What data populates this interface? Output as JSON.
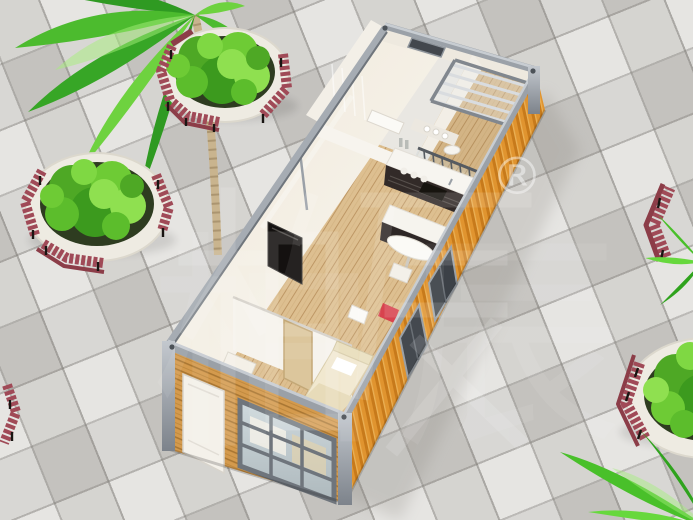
{
  "watermark": {
    "text": "柏辰",
    "registered": "®"
  },
  "palette": {
    "plaza_tile": "#d6d4d0",
    "tile_grout": "#b4b2ae",
    "container_orange": "#ed9c35",
    "container_orange_dark": "#d17f1f",
    "steel_frame": "#9aa0a7",
    "interior_wall": "#f6f2ea",
    "wood_floor": "#ddbf90",
    "facade_slat": "#d49a4d",
    "cabinet_dark": "#322a28",
    "counter_white": "#f7f5f0",
    "bed_linen": "#f1e8cf",
    "bedroom_door_tan": "#dcc69c",
    "bench_red": "#a04a57",
    "bench_back_red": "#8c3d48",
    "planter_white": "#eeebe2",
    "soil_dark": "#2e3c20",
    "plant_green": "#6ecb35",
    "palm_trunk": "#c9b48e",
    "tv_black": "#141110",
    "window_dark": "#3c4147"
  },
  "scene": {
    "setting": "aerial view of a tiled outdoor plaza",
    "building": {
      "type": "flat-pack container house shown with roof removed (dollhouse cutaway)",
      "exterior": [
        "orange corrugated steel side wall",
        "gray steel frame and corner posts",
        "wood-slat front facade with white door and gridded window"
      ],
      "rooms": [
        "bathroom",
        "glazed balcony with pergola slats",
        "kitchen",
        "living area",
        "bedroom",
        "hallway"
      ],
      "furniture": [
        "wall-mounted TV",
        "kitchen cabinets and counters",
        "bar table with stool",
        "bed with headboard shelf",
        "wardrobe",
        "tan bedroom door",
        "red accent chair",
        "balcony chair"
      ]
    },
    "landscaping": {
      "palm_trees": 3,
      "planters": 4,
      "planter_style": "round white stone planters with green shrubs",
      "bench_style": "curved red-brown slat benches with black metal legs"
    }
  }
}
